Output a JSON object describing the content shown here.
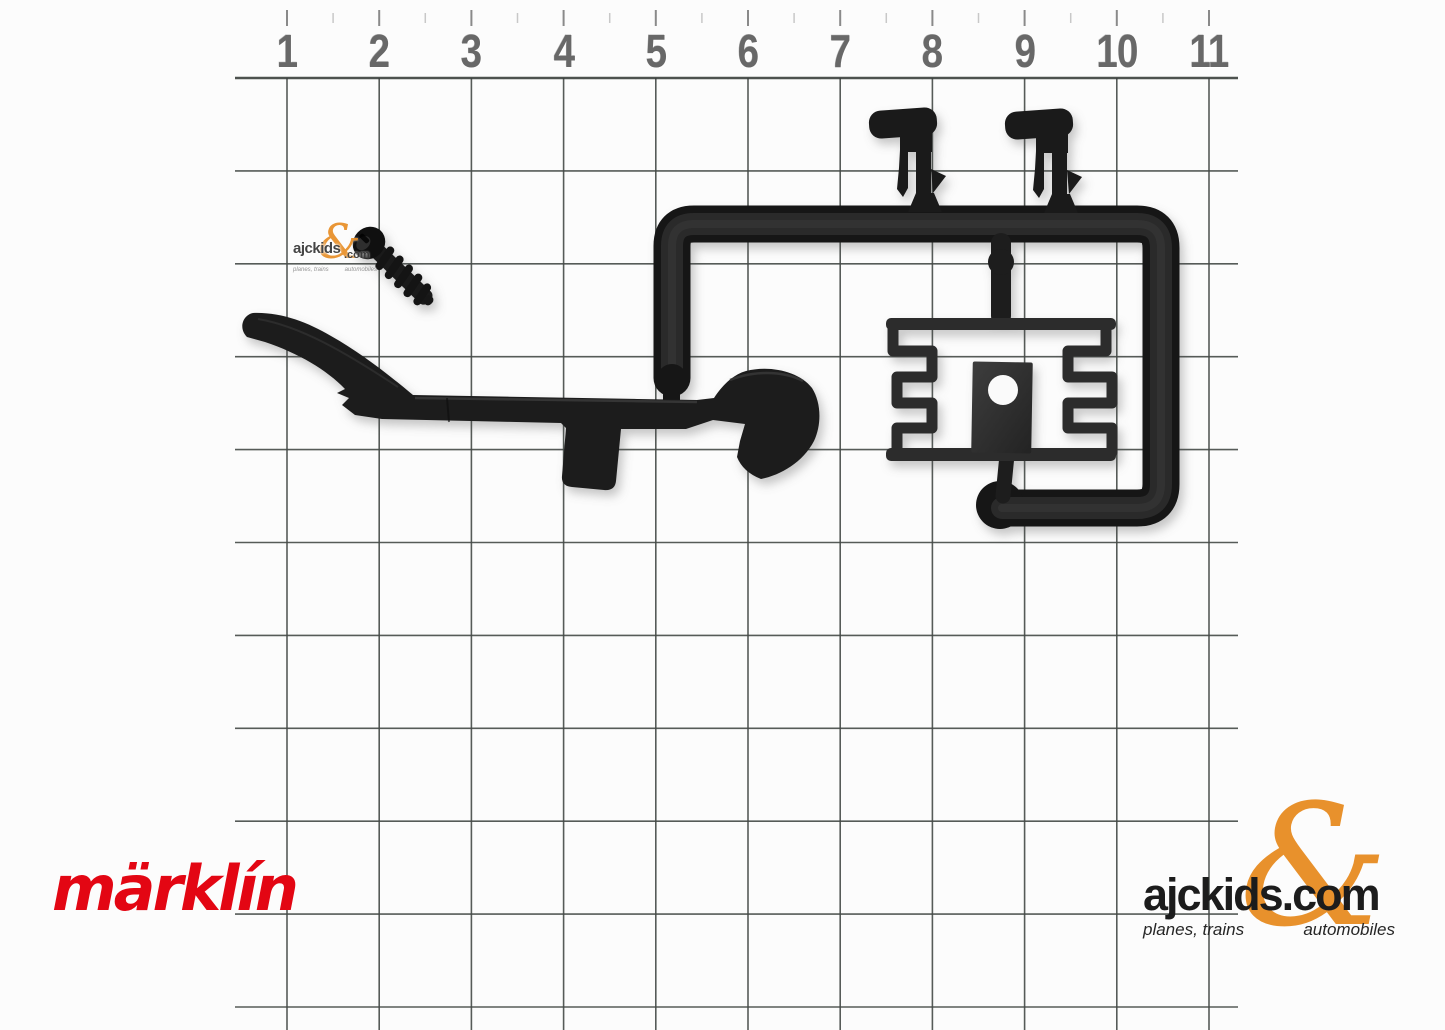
{
  "ruler": {
    "labels": [
      "1",
      "2",
      "3",
      "4",
      "5",
      "6",
      "7",
      "8",
      "9",
      "10",
      "11"
    ]
  },
  "watermark": {
    "name": "ajckids",
    "ampersand": "&",
    "domain": ".com",
    "tagline_left": "planes, trains",
    "tagline_right": "automobiles"
  },
  "logos": {
    "marklin": {
      "text": "märklín",
      "color": "#e30613"
    },
    "ajckids": {
      "wordmark": "ajckids.com",
      "ampersand": "&",
      "tagline_left": "planes, trains",
      "tagline_right": "automobiles",
      "orange": "#e8912c",
      "black": "#1c1c1c"
    }
  },
  "objects": [
    "black mounting screw",
    "coupler drawbar with hook",
    "sprue frame with two snap clips",
    "contact spring plate with hole"
  ],
  "colors": {
    "paper": "#fcfcfc",
    "grid_line": "#454a47",
    "ruler_number": "#686868",
    "part_black": "#1a1a1a",
    "marklin_red": "#e30613",
    "ajckids_orange": "#e8912c"
  }
}
